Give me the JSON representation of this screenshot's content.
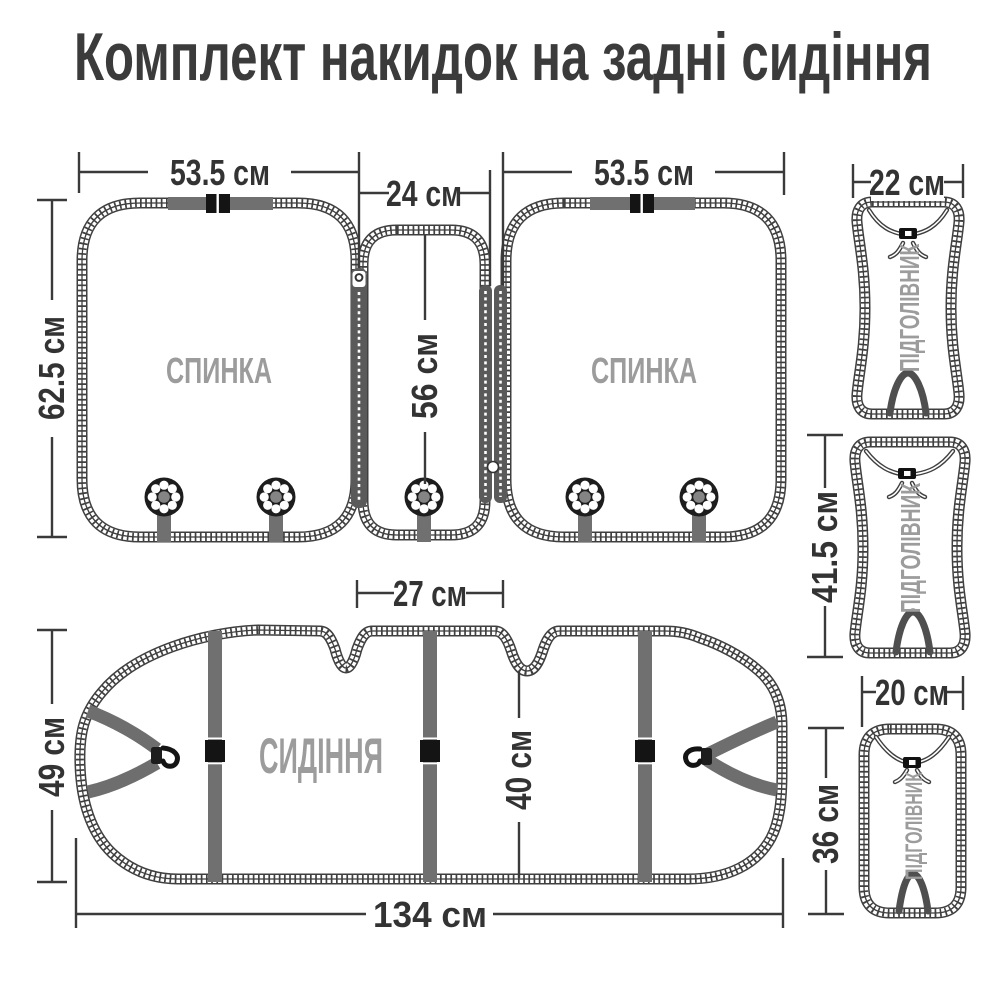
{
  "title": "Комплект накидок на задні сидіння",
  "pieces": {
    "backrest_left": {
      "label": "СПИНКА",
      "width": "53.5 см",
      "height": "62.5 см"
    },
    "connector_middle": {
      "width": "24 см",
      "height": "56 см"
    },
    "backrest_right": {
      "label": "СПИНКА",
      "width": "53.5 см"
    },
    "headrest_top": {
      "label": "ПІДГОЛІВНИК",
      "width": "22 см"
    },
    "headrest_middle": {
      "label": "ПІДГОЛІВНИК",
      "height": "41.5 см"
    },
    "headrest_bottom": {
      "label": "ПІДГОЛІВНИК",
      "width": "20 см",
      "height": "36 см"
    },
    "seat": {
      "label": "СИДІННЯ",
      "width": "134 см",
      "height": "49 см",
      "belt_gap": "27 см",
      "depth": "40 см"
    }
  },
  "colors": {
    "outline": "#3f3f3f",
    "dimension_text": "#333333",
    "piece_label": "#9c9c9c",
    "strap": "#707070",
    "buckle": "#141414",
    "background": "#ffffff"
  }
}
